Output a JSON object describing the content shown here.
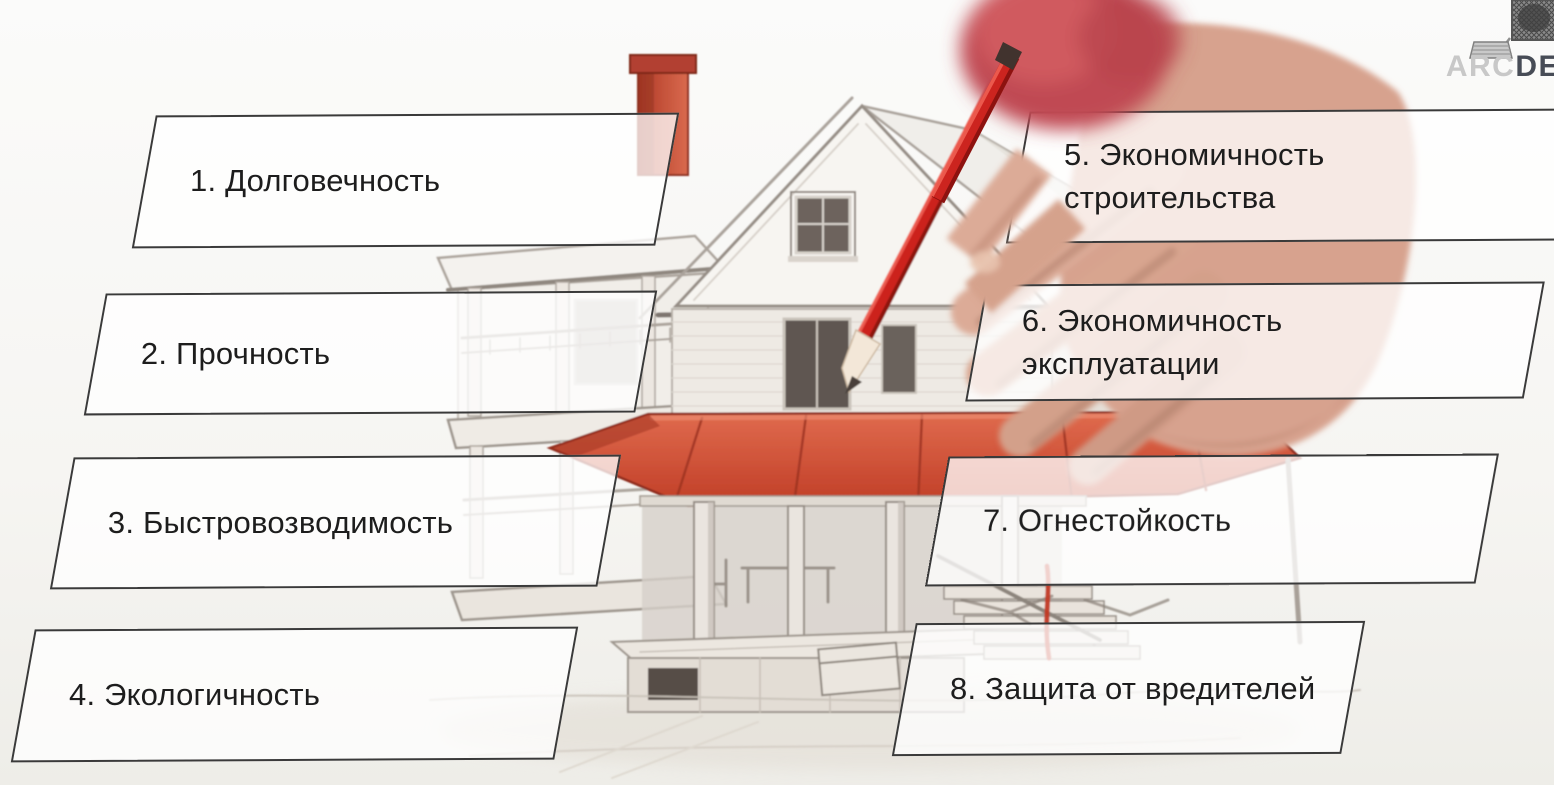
{
  "slide": {
    "title": "Требования к зданиям",
    "background_top": "#fbfbfa",
    "background_bottom": "#eeede8"
  },
  "logo": {
    "text_light": "ARC",
    "text_dark": "DE",
    "icon": "column-capital-sketch-icon"
  },
  "requirements": [
    {
      "num": 1,
      "line1": "1. Долговечность",
      "line2": ""
    },
    {
      "num": 2,
      "line1": "2. Прочность",
      "line2": ""
    },
    {
      "num": 3,
      "line1": "3. Быстровозводимость",
      "line2": ""
    },
    {
      "num": 4,
      "line1": "4. Экологичность",
      "line2": ""
    },
    {
      "num": 5,
      "line1": "5. Экономичность",
      "line2": "строительства"
    },
    {
      "num": 6,
      "line1": "6. Экономичность",
      "line2": "эксплуатации"
    },
    {
      "num": 7,
      "line1": "7. Огнестойкость",
      "line2": ""
    },
    {
      "num": 8,
      "line1": "8. Защита от вредителей",
      "line2": ""
    }
  ],
  "illustration": {
    "subject": "pencil sketch of two-story house, hand drawing with red pencil",
    "accent_red": "#c84a31",
    "awning_red": "#c03d26",
    "pencil_red": "#cc241f",
    "skin_tone": "#d7a28e",
    "sketch_line_gray": "#a9a29a",
    "box_border": "#3a3a3a",
    "box_fill": "rgba(255,255,255,0.76)",
    "text_color": "#1d1d1d"
  }
}
